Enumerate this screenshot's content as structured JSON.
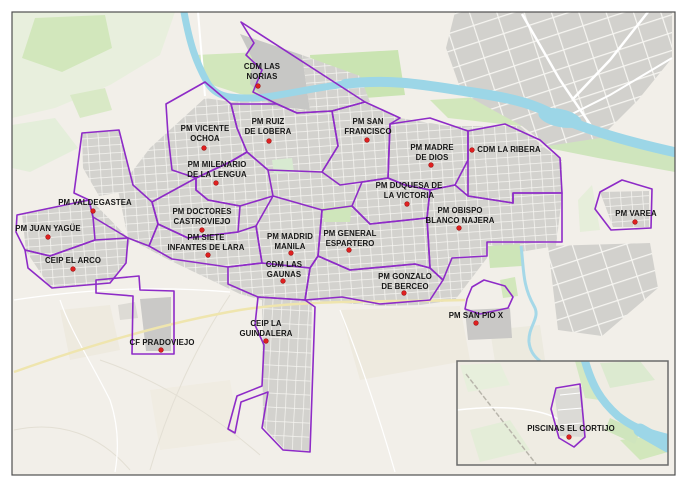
{
  "map": {
    "description": "Municipal facilities zoning map",
    "colors": {
      "zone_outline": "#8e2bc7",
      "marker_fill": "#e02020",
      "marker_edge": "#9b1414",
      "label_text": "#161616",
      "water": "#9cd6e7",
      "land": "#f2efe9",
      "buildings": "#d3d2ce",
      "green": "#cfe5bb",
      "frame": "#4f4f4f",
      "inset_frame": "#6b6b6b"
    },
    "frame": {
      "x": 12,
      "y": 12,
      "w": 663,
      "h": 463
    },
    "inset": {
      "x": 457,
      "y": 361,
      "w": 211,
      "h": 104
    },
    "marker_radius": 2.3,
    "facilities": [
      {
        "id": "cdm-las-norias",
        "name": "CDM LAS NORIAS",
        "lines": [
          "CDM LAS",
          "NORIAS"
        ],
        "x": 262,
        "y": 69,
        "dot_x": 258,
        "dot_y": 86,
        "layer": "main"
      },
      {
        "id": "pm-ruiz-de-lobera",
        "name": "PM RUIZ DE LOBERA",
        "lines": [
          "PM RUIZ",
          "DE LOBERA"
        ],
        "x": 268,
        "y": 124,
        "dot_x": 269,
        "dot_y": 141,
        "layer": "main"
      },
      {
        "id": "pm-vicente-ochoa",
        "name": "PM VICENTE OCHOA",
        "lines": [
          "PM VICENTE",
          "OCHOA"
        ],
        "x": 205,
        "y": 131,
        "dot_x": 204,
        "dot_y": 148,
        "layer": "main"
      },
      {
        "id": "pm-san-francisco",
        "name": "PM SAN FRANCISCO",
        "lines": [
          "PM SAN",
          "FRANCISCO"
        ],
        "x": 368,
        "y": 124,
        "dot_x": 367,
        "dot_y": 140,
        "layer": "main"
      },
      {
        "id": "pm-milenario-de-la-lengua",
        "name": "PM MILENARIO DE LA LENGUA",
        "lines": [
          "PM MILENARIO",
          "DE LA LENGUA"
        ],
        "x": 217,
        "y": 167,
        "dot_x": 216,
        "dot_y": 183,
        "layer": "main"
      },
      {
        "id": "pm-madre-de-dios",
        "name": "PM MADRE DE DIOS",
        "lines": [
          "PM MADRE",
          "DE DIOS"
        ],
        "x": 432,
        "y": 150,
        "dot_x": 431,
        "dot_y": 165,
        "layer": "main"
      },
      {
        "id": "cdm-la-ribera",
        "name": "CDM LA RIBERA",
        "lines": [
          "CDM LA RIBERA"
        ],
        "x": 509,
        "y": 152,
        "dot_x": 472,
        "dot_y": 150,
        "layer": "main"
      },
      {
        "id": "pm-valdegastea",
        "name": "PM VALDEGASTEA",
        "lines": [
          "PM VALDEGASTEA"
        ],
        "x": 95,
        "y": 205,
        "dot_x": 93,
        "dot_y": 211,
        "layer": "main"
      },
      {
        "id": "pm-juan-yague",
        "name": "PM JUAN YAGÜE",
        "lines": [
          "PM JUAN YAGÜE"
        ],
        "x": 48,
        "y": 231,
        "dot_x": 48,
        "dot_y": 237,
        "layer": "main"
      },
      {
        "id": "pm-doctores-castroviejo",
        "name": "PM DOCTORES CASTROVIEJO",
        "lines": [
          "PM DOCTORES",
          "CASTROVIEJO"
        ],
        "x": 202,
        "y": 214,
        "dot_x": 202,
        "dot_y": 230,
        "layer": "main"
      },
      {
        "id": "pm-duquesa-de-la-victoria",
        "name": "PM DUQUESA DE LA VICTORIA",
        "lines": [
          "PM DUQUESA DE",
          "LA VICTORIA"
        ],
        "x": 409,
        "y": 188,
        "dot_x": 407,
        "dot_y": 204,
        "layer": "main"
      },
      {
        "id": "pm-obispo-blanco-najera",
        "name": "PM OBISPO BLANCO NAJERA",
        "lines": [
          "PM OBISPO",
          "BLANCO NAJERA"
        ],
        "x": 460,
        "y": 213,
        "dot_x": 459,
        "dot_y": 228,
        "layer": "main"
      },
      {
        "id": "pm-varea",
        "name": "PM VAREA",
        "lines": [
          "PM VAREA"
        ],
        "x": 636,
        "y": 216,
        "dot_x": 635,
        "dot_y": 222,
        "layer": "main"
      },
      {
        "id": "ceip-el-arco",
        "name": "CEIP EL ARCO",
        "lines": [
          "CEIP EL ARCO"
        ],
        "x": 73,
        "y": 263,
        "dot_x": 73,
        "dot_y": 269,
        "layer": "main"
      },
      {
        "id": "pm-siete-infantes-de-lara",
        "name": "PM SIETE INFANTES DE LARA",
        "lines": [
          "PM SIETE",
          "INFANTES DE LARA"
        ],
        "x": 206,
        "y": 240,
        "dot_x": 208,
        "dot_y": 255,
        "layer": "main"
      },
      {
        "id": "pm-madrid-manila",
        "name": "PM MADRID MANILA",
        "lines": [
          "PM MADRID",
          "MANILA"
        ],
        "x": 290,
        "y": 239,
        "dot_x": 291,
        "dot_y": 253,
        "layer": "main"
      },
      {
        "id": "pm-general-espartero",
        "name": "PM GENERAL ESPARTERO",
        "lines": [
          "PM GENERAL",
          "ESPARTERO"
        ],
        "x": 350,
        "y": 236,
        "dot_x": 349,
        "dot_y": 250,
        "layer": "main"
      },
      {
        "id": "cdm-las-gaunas",
        "name": "CDM LAS GAUNAS",
        "lines": [
          "CDM LAS",
          "GAUNAS"
        ],
        "x": 284,
        "y": 267,
        "dot_x": 283,
        "dot_y": 281,
        "layer": "main"
      },
      {
        "id": "pm-gonzalo-de-berceo",
        "name": "PM GONZALO DE BERCEO",
        "lines": [
          "PM GONZALO",
          "DE BERCEO"
        ],
        "x": 405,
        "y": 279,
        "dot_x": 404,
        "dot_y": 293,
        "layer": "main"
      },
      {
        "id": "pm-san-pio-x",
        "name": "PM SAN PIO X",
        "lines": [
          "PM SAN PIO X"
        ],
        "x": 476,
        "y": 318,
        "dot_x": 476,
        "dot_y": 323,
        "layer": "main"
      },
      {
        "id": "ceip-la-guindalera",
        "name": "CEIP LA GUINDALERA",
        "lines": [
          "CEIP LA",
          "GUINDALERA"
        ],
        "x": 266,
        "y": 326,
        "dot_x": 266,
        "dot_y": 341,
        "layer": "main"
      },
      {
        "id": "cf-pradoviejo",
        "name": "CF PRADOVIEJO",
        "lines": [
          "CF PRADOVIEJO"
        ],
        "x": 162,
        "y": 345,
        "dot_x": 161,
        "dot_y": 350,
        "layer": "main"
      },
      {
        "id": "piscinas-el-cortijo",
        "name": "PISCINAS EL CORTIJO",
        "lines": [
          "PISCINAS EL CORTIJO"
        ],
        "x": 571,
        "y": 431,
        "dot_x": 569,
        "dot_y": 437,
        "layer": "inset"
      }
    ],
    "zones": [
      {
        "id": "cdm-las-norias",
        "points": "241,22 365,102 332,111 297,113 277,104 253,92 262,70 246,55 254,43",
        "layer": "main"
      },
      {
        "id": "pm-ruiz-de-lobera",
        "points": "231,104 277,104 297,113 332,111 338,146 322,172 268,170 247,152 237,128",
        "layer": "main"
      },
      {
        "id": "pm-vicente-ochoa",
        "points": "166,104 205,82 231,104 237,128 247,152 230,162 196,178 172,170 168,135",
        "layer": "main"
      },
      {
        "id": "pm-milenario-de-la-lengua",
        "points": "196,178 230,162 247,152 268,170 273,196 240,206 208,200 196,190",
        "layer": "main"
      },
      {
        "id": "pm-san-francisco",
        "points": "332,111 365,102 400,118 390,124 388,178 362,182 340,185 322,172 338,146",
        "layer": "main"
      },
      {
        "id": "pm-madre-de-dios",
        "points": "390,124 430,118 468,131 468,160 455,185 430,190 405,185 388,178",
        "layer": "main"
      },
      {
        "id": "cdm-la-ribera",
        "points": "468,131 505,124 540,140 560,158 562,193 513,193 513,203 468,196",
        "layer": "main"
      },
      {
        "id": "pm-duquesa-de-la-victoria",
        "points": "362,182 388,178 405,185 430,190 427,218 370,224 352,206",
        "layer": "main"
      },
      {
        "id": "pm-obispo-blanco-najera",
        "points": "430,190 455,185 468,196 513,203 513,193 562,193 562,242 487,242 487,256 452,258 443,280 430,268 427,218",
        "layer": "main"
      },
      {
        "id": "pm-general-espartero",
        "points": "322,210 352,206 370,224 427,218 430,268 415,264 350,270 318,256",
        "layer": "main"
      },
      {
        "id": "pm-madrid-manila",
        "points": "273,196 322,210 318,256 310,268 262,263 256,226",
        "layer": "main"
      },
      {
        "id": "pm-doctores-castroviejo",
        "points": "152,202 196,178 196,190 208,200 240,206 238,232 188,238 158,224",
        "layer": "main"
      },
      {
        "id": "pm-siete-infantes-de-lara",
        "points": "158,224 188,238 238,232 256,226 262,263 228,267 172,259 149,246",
        "layer": "main"
      },
      {
        "id": "pm-valdegastea",
        "points": "74,193 82,133 119,130 133,185 152,202 158,224 149,246 128,238 93,217 89,200",
        "layer": "main"
      },
      {
        "id": "pm-juan-yague",
        "points": "17,215 89,200 93,217 95,240 50,256 25,250 16,232",
        "layer": "main"
      },
      {
        "id": "ceip-el-arco",
        "points": "25,250 50,256 95,240 128,238 126,263 110,283 52,288 28,268",
        "layer": "main"
      },
      {
        "id": "cdm-las-gaunas",
        "points": "262,263 310,268 305,300 258,297 228,284 228,267",
        "layer": "main"
      },
      {
        "id": "ceip-la-guindalera",
        "points": "258,297 305,300 315,307 310,452 283,450 262,428 268,392 241,402 235,433 228,429 237,396 262,386 264,345 255,325",
        "layer": "main"
      },
      {
        "id": "cf-pradoviejo",
        "points": "96,280 139,276 140,290 174,291 174,354 132,354 133,296 96,293",
        "layer": "main"
      },
      {
        "id": "pm-gonzalo-de-berceo",
        "points": "318,256 350,270 415,264 430,268 443,280 430,300 380,304 342,297 305,300 310,268",
        "layer": "main"
      },
      {
        "id": "pm-san-pio-x",
        "points": "467,299 472,287 484,280 505,286 513,297 508,308 480,314 465,309",
        "layer": "main"
      },
      {
        "id": "pm-varea",
        "points": "622,180 652,189 651,228 611,230 595,209 600,192",
        "layer": "main"
      },
      {
        "id": "piscinas-el-cortijo",
        "points": "556,388 580,384 585,437 574,447 559,438 551,409",
        "layer": "inset"
      }
    ]
  }
}
